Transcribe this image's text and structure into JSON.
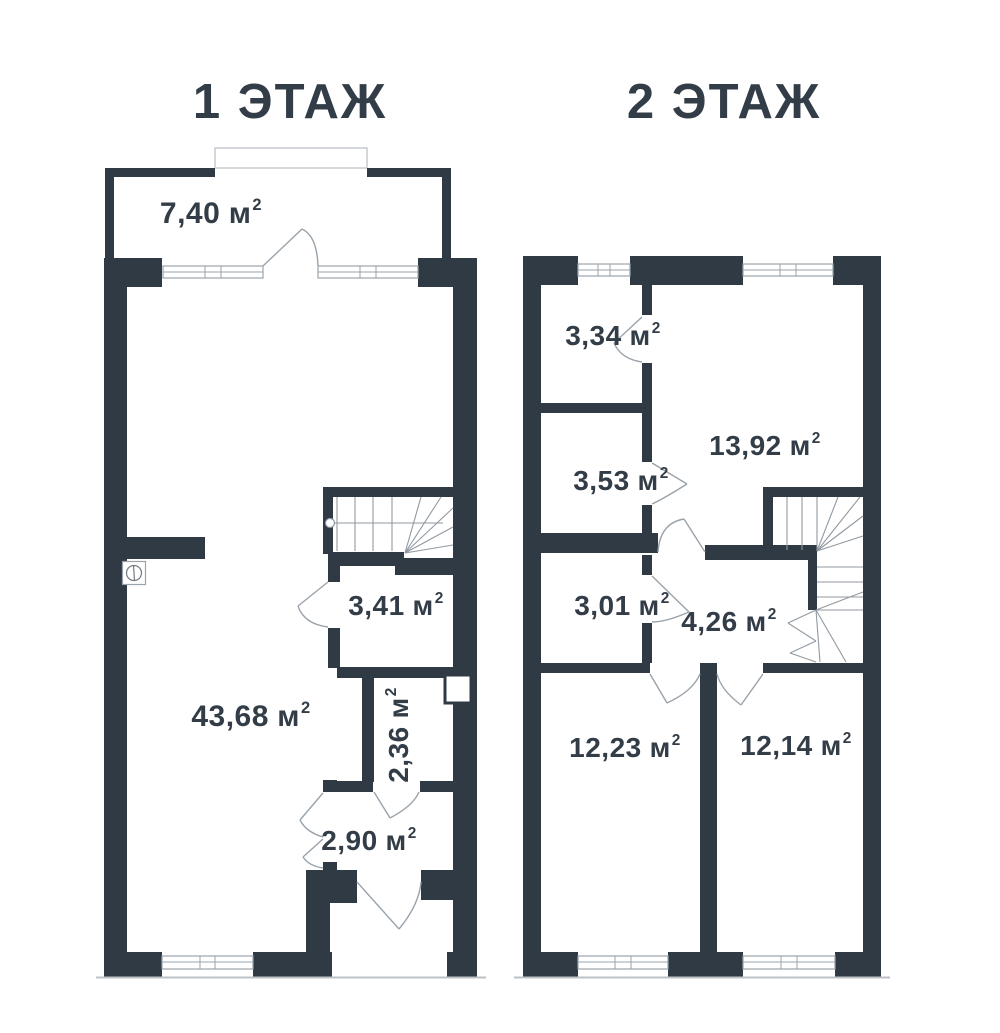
{
  "palette": {
    "wall": "#2F3A45",
    "door_line": "#9AA3AB",
    "stair_line": "#9199A1",
    "ground_line": "#BDC2C8",
    "text": "#333D47",
    "bg": "#FFFFFF"
  },
  "unit": {
    "base": "м",
    "exp": "2"
  },
  "floor1": {
    "title": "1 ЭТАЖ",
    "rooms": [
      {
        "area": "7,40"
      },
      {
        "area": "43,68"
      },
      {
        "area": "3,41"
      },
      {
        "area": "2,36"
      },
      {
        "area": "2,90"
      }
    ]
  },
  "floor2": {
    "title": "2 ЭТАЖ",
    "rooms": [
      {
        "area": "3,34"
      },
      {
        "area": "13,92"
      },
      {
        "area": "3,53"
      },
      {
        "area": "3,01"
      },
      {
        "area": "4,26"
      },
      {
        "area": "12,23"
      },
      {
        "area": "12,14"
      }
    ]
  }
}
